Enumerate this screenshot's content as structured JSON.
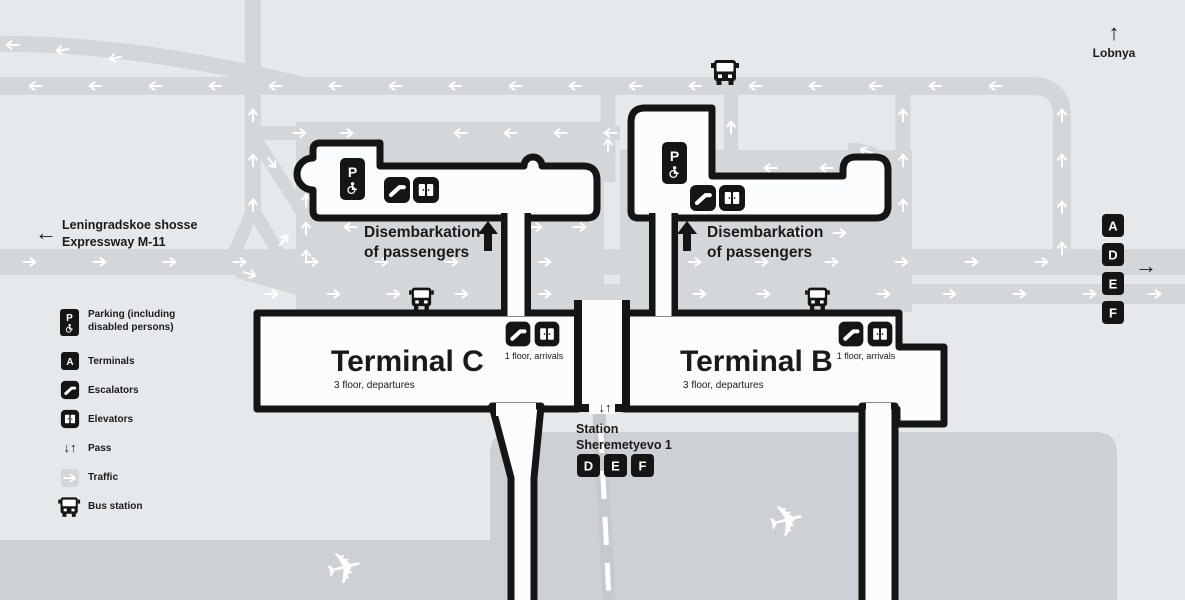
{
  "colors": {
    "background": "#e6e9ec",
    "road": "#d3d7da",
    "apron": "#cdd1d5",
    "building_fill": "#fbfcfd",
    "ink": "#151515",
    "arrow_white": "#ffffff",
    "track": "#c6cacd"
  },
  "icons": {
    "pass": "↓↑",
    "up_arrow": "↑",
    "left_arrow": "←",
    "right_arrow": "→",
    "plane": "✈"
  },
  "map": {
    "lobnya_label": "Lobnya",
    "expressway": {
      "line1": "Leningradskoe shosse",
      "line2": "Expressway M-11"
    },
    "parking_letter": "P",
    "disembark_c": {
      "line1": "Disembarkation",
      "line2": "of passengers"
    },
    "disembark_b": {
      "line1": "Disembarkation",
      "line2": "of passengers"
    },
    "terminal_c": {
      "title": "Terminal C",
      "subtitle": "3 floor, departures",
      "arrivals": "1 floor, arrivals"
    },
    "terminal_b": {
      "title": "Terminal B",
      "subtitle": "3 floor, departures",
      "arrivals": "1 floor, arrivals"
    },
    "station": {
      "line1": "Station",
      "line2": "Sheremetyevo 1",
      "badges": [
        "D",
        "E",
        "F"
      ]
    },
    "right_badges": [
      "A",
      "D",
      "E",
      "F"
    ]
  },
  "legend": {
    "terminal_letter": "A",
    "items": [
      {
        "icon": "parking-icon",
        "lines": [
          "Parking (including",
          "disabled persons)"
        ]
      },
      {
        "icon": "terminal-badge-icon",
        "lines": [
          "Terminals"
        ]
      },
      {
        "icon": "escalator-icon",
        "lines": [
          "Escalators"
        ]
      },
      {
        "icon": "elevator-icon",
        "lines": [
          "Elevators"
        ]
      },
      {
        "icon": "pass-icon",
        "lines": [
          "Pass"
        ]
      },
      {
        "icon": "traffic-icon",
        "lines": [
          "Traffic"
        ]
      },
      {
        "icon": "bus-icon",
        "lines": [
          "Bus station"
        ]
      }
    ]
  }
}
